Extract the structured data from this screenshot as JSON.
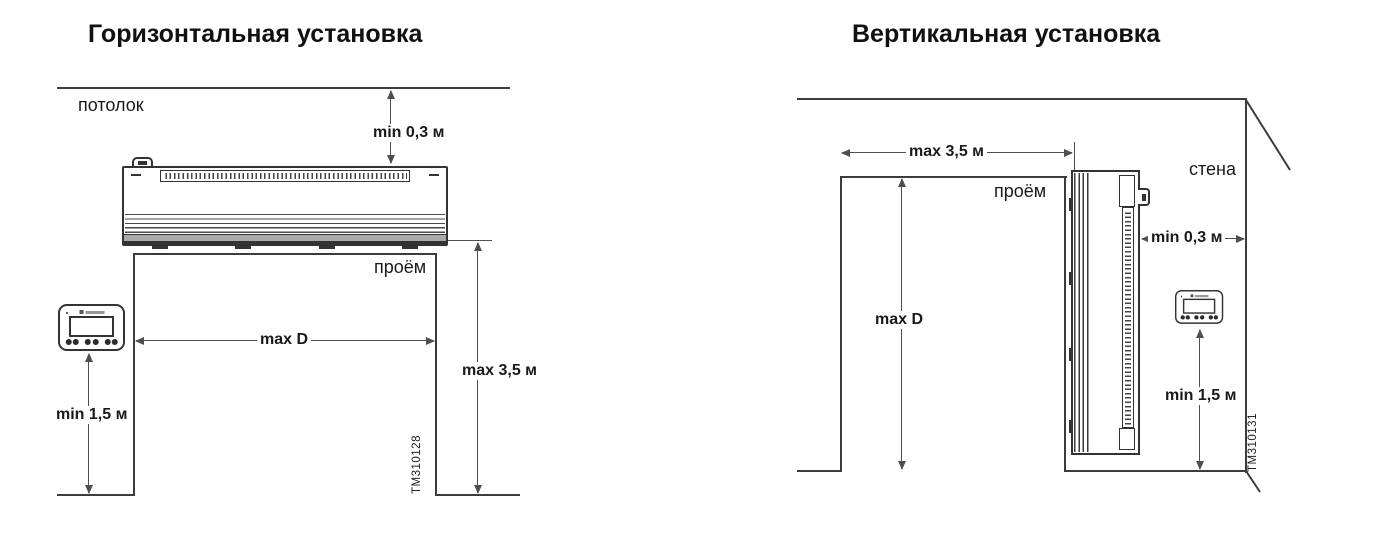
{
  "colors": {
    "background": "#ffffff",
    "line": "#3c3c3c",
    "dim_line": "#4f4f4f",
    "text": "#1a1a1a"
  },
  "diagrams": [
    {
      "id": "horizontal",
      "title": "Горизонтальная установка",
      "labels": {
        "ceiling": "потолок",
        "opening": "проём"
      },
      "dimensions": {
        "ceiling_gap": "min 0,3 м",
        "opening_width": "max D",
        "opening_height": "max 3,5 м",
        "controller_height": "min 1,5 м"
      },
      "figure_code": "TM310128"
    },
    {
      "id": "vertical",
      "title": "Вертикальная установка",
      "labels": {
        "wall": "стена",
        "opening": "проём"
      },
      "dimensions": {
        "opening_width": "max 3,5 м",
        "opening_height": "max D",
        "wall_gap": "min 0,3 м",
        "controller_height": "min 1,5 м"
      },
      "figure_code": "TM310131"
    }
  ]
}
